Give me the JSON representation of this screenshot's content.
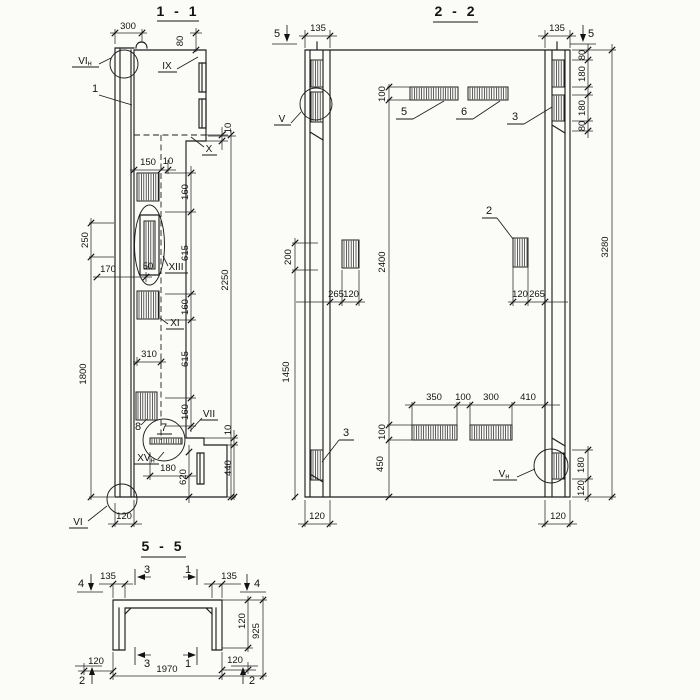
{
  "colors": {
    "background": "#fbfbf8",
    "ink": "#1e1e1e"
  },
  "sections": {
    "s1": {
      "title": "1 - 1",
      "labels": {
        "d300": "300",
        "d80": "80",
        "d150": "150",
        "d10a": "10",
        "d10b": "10",
        "d160a": "160",
        "d615a": "615",
        "d250": "250",
        "d170": "170",
        "d50": "50",
        "d2250": "2250",
        "d160b": "160",
        "d310": "310",
        "d615b": "615",
        "d1800": "1800",
        "d160c": "160",
        "d180": "180",
        "d620": "620",
        "d440": "440",
        "d10c": "10",
        "d120": "120",
        "r_vin_main": "VI",
        "r_vin_sub": "н",
        "r_ix": "IX",
        "r_x": "X",
        "r_xiii": "XIII",
        "r_xi": "XI",
        "r_vii": "VII",
        "r_xvn_main": "XV",
        "r_xvn_sub": "н",
        "r_vi": "VI",
        "p1": "1",
        "p7": "7",
        "p8": "8"
      }
    },
    "s2": {
      "title": "2 - 2",
      "labels": {
        "m5l": "5",
        "m5r": "5",
        "d135l": "135",
        "d135r": "135",
        "d80a": "80",
        "d180a": "180",
        "d180b": "180",
        "d80b": "80",
        "d3280": "3280",
        "r_v": "V",
        "d100a": "100",
        "p5": "5",
        "p6": "6",
        "p3a": "3",
        "d200": "200",
        "d2400": "2400",
        "d265l": "265",
        "d120l": "120",
        "p2": "2",
        "d120r": "120",
        "d265r": "265",
        "d1450": "1450",
        "d350": "350",
        "d100b": "100",
        "d300": "300",
        "d410": "410",
        "d100c": "100",
        "d450": "450",
        "p3b": "3",
        "r_vn_main": "V",
        "r_vn_sub": "н",
        "d180c": "180",
        "d120rb": "120",
        "d120bl": "120",
        "d120br": "120"
      }
    },
    "s5": {
      "title": "5 - 5",
      "labels": {
        "m4l": "4",
        "m4r": "4",
        "m3t": "3",
        "m1t": "1",
        "m3b": "3",
        "m1b": "1",
        "m2l": "2",
        "m2r": "2",
        "d135l": "135",
        "d135r": "135",
        "d120r": "120",
        "d925": "925",
        "d120bl": "120",
        "d120br": "120",
        "d1970": "1970"
      }
    }
  }
}
